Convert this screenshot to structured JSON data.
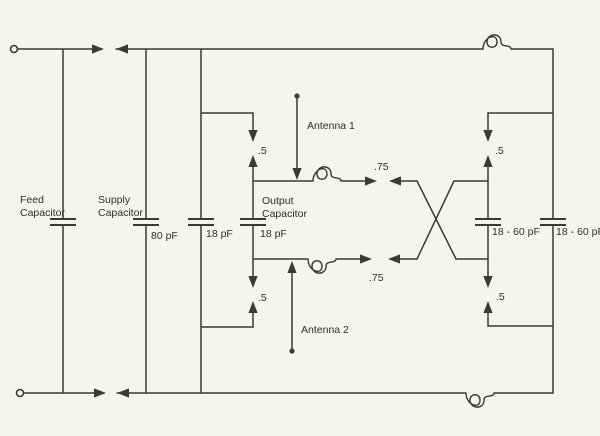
{
  "colors": {
    "paper": "#f5f4ef",
    "ink": "#3a3a3a",
    "text": "#2e2e2e"
  },
  "labels": {
    "feed_cap_line1": "Feed",
    "feed_cap_line2": "Capacitor",
    "supply_cap_line1": "Supply",
    "supply_cap_line2": "Capacitor",
    "supply_cap_value": "80 pF",
    "cap18_value": "18 pF",
    "output_cap_line1": "Output",
    "output_cap_line2": "Capacitor",
    "output_cap_value": "18 pF",
    "varcap1_value": "18 - 60 pF",
    "varcap2_value": "18 - 60 pF",
    "antenna1": "Antenna 1",
    "antenna2": "Antenna 2",
    "link_top_left": ".5",
    "link_bottom_left": ".5",
    "link_top_right": ".5",
    "link_bottom_right": ".5",
    "coupling_top": ".75",
    "coupling_bottom": ".75"
  }
}
